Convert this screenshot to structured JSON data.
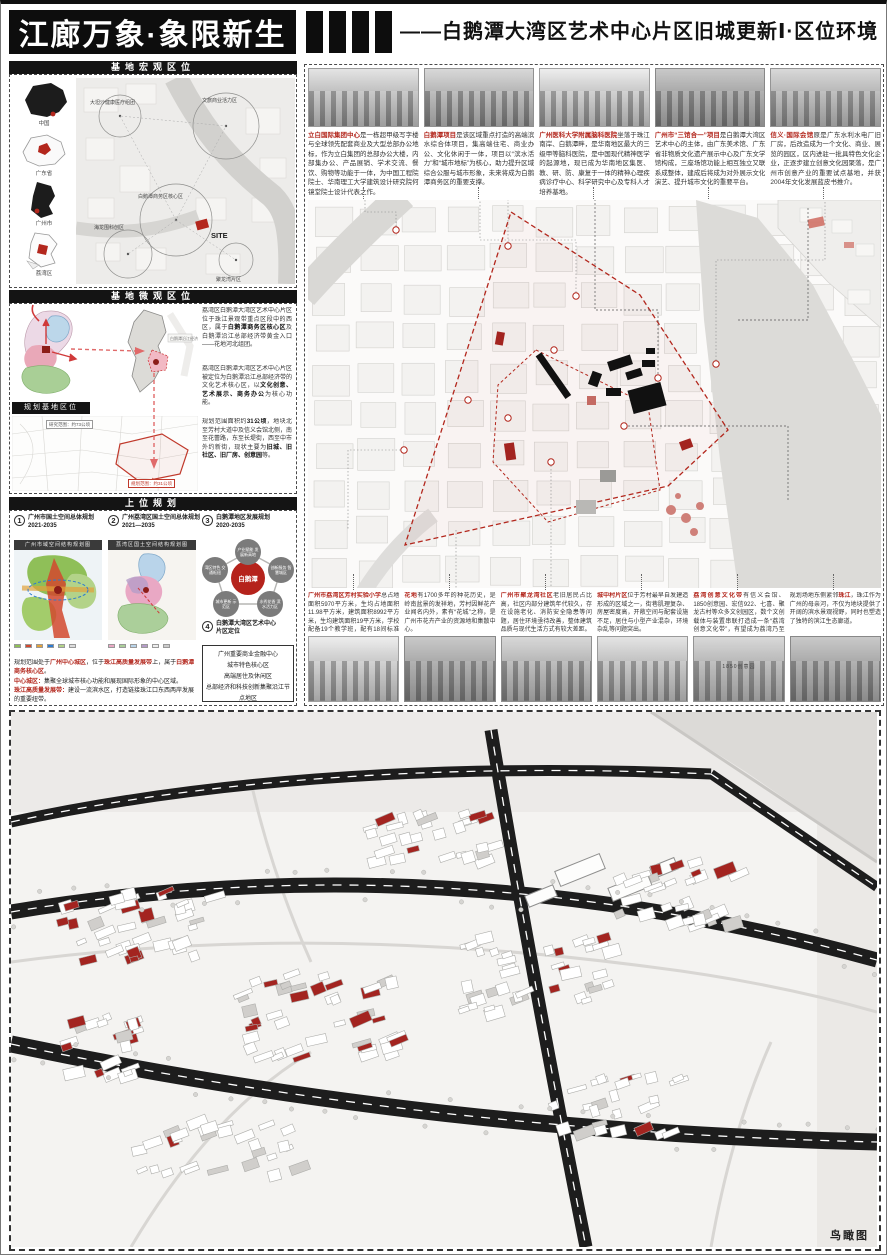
{
  "page": {
    "aerial_label": "鸟瞰图"
  },
  "colors": {
    "accent": "#b3271d",
    "black": "#141414"
  },
  "header": {
    "logo": "江廊万象·象限新生",
    "title": "——白鹅潭大湾区艺术中心片区旧城更新Ⅰ·区位环境"
  },
  "left": {
    "macro_title": "基地宏观区位",
    "inset_captions": [
      "中国",
      "广东省",
      "广州市",
      "荔湾区"
    ],
    "macro_labels": [
      "大坦沙健康医疗组团",
      "文旅商业活力区",
      "白鹅潭商务区核心区",
      "SITE",
      "聚龙湾片区",
      "海龙围科创区"
    ],
    "micro_title": "基地微观区位",
    "micro_para1": [
      {
        "t": "荔湾区白鹅潭大湾区艺术中心片区位于珠江景观带重点区段中的西区，属于"
      },
      {
        "t": "白鹅潭商务区核心区",
        "s": "b"
      },
      {
        "t": "及白鹅潭沿江总部经济带黄金入口——花地河北组团。"
      }
    ],
    "micro_para2": [
      {
        "t": "荔湾区白鹅潭大湾区艺术中心片区被定位为白鹅潭沿江总部经济带的文化艺术核心区，以"
      },
      {
        "t": "文化创意、艺术展示、商务办公",
        "s": "b"
      },
      {
        "t": "为核心功能。"
      }
    ],
    "base_tag": "规划基地区位",
    "base_note_top": "研究范围：约73公顷",
    "base_note": "规划范围：约31公顷",
    "base_para": [
      {
        "t": "规划范围面积约"
      },
      {
        "t": "31公顷",
        "s": "b"
      },
      {
        "t": "，地块北至芳村大道中及信义会馆北侧，南至花蕾路，东至长堤街，西至中市外约新街，现状主要为"
      },
      {
        "t": "旧城、旧社区、旧厂房、创意园",
        "s": "b"
      },
      {
        "t": "等。"
      }
    ],
    "upper_title": "上位规划",
    "items": [
      {
        "num": "1",
        "l1": "广州市国土空间总体规划",
        "l2": "2021-2035"
      },
      {
        "num": "2",
        "l1": "广州荔湾区国土空间总体规划",
        "l2": "2021—2035"
      },
      {
        "num": "3",
        "l1": "白鹅潭地区发展规划",
        "l2": "2020-2035"
      },
      {
        "num": "4",
        "l1": "白鹅潭大湾区艺术中心",
        "l2": "片区定位"
      }
    ],
    "map1_title": "广州市域空间结构规划图",
    "map2_title": "荔湾区国土空间结构规划图",
    "diagram": {
      "center": "白鹅潭",
      "nodes": [
        "产业赋能 发展新高地",
        "创新服务 智慧城区",
        "水秀花香 滨水活力区",
        "城市更新 示范区",
        "湾区特色 交通枢纽"
      ]
    },
    "position_box": [
      "广州重要商业金融中心",
      "城市特色核心区",
      "高端居住及休闲区",
      "总部经济和科技创新集聚沿江节点地区"
    ],
    "footer": [
      [
        {
          "t": "规划范围处于"
        },
        {
          "t": "广州中心城区",
          "s": "hl"
        },
        {
          "t": "，位于"
        },
        {
          "t": "珠江高质量发展带",
          "s": "hl"
        },
        {
          "t": "上，属于"
        },
        {
          "t": "白鹅潭商务核心区",
          "s": "hl"
        },
        {
          "t": "。"
        }
      ],
      [
        {
          "t": "中心城区：",
          "s": "hl"
        },
        {
          "t": "集聚全球城市核心功能和展现国际形象的中心区域。"
        }
      ],
      [
        {
          "t": "珠江高质量发展带：",
          "s": "hl"
        },
        {
          "t": "建设一流滨水区，打造链接珠江口东西两岸发展的重要纽带。"
        }
      ],
      [
        {
          "t": "白鹅潭商务核心区：",
          "s": "hl"
        },
        {
          "t": "积极赋能，打造链接珠江西岸的商务核心区。"
        }
      ]
    ]
  },
  "top_captions": [
    {
      "text": [
        {
          "t": "立白国际集团中心",
          "s": "hl"
        },
        {
          "t": "是一栋超甲级写字楼与全球领先配套商业及大型总部办公地标，作为立白集团的总部办公大楼，内部集办公、产品展销、学术交流、餐饮、购物等功能于一体，为中国工程院院士、华南理工大学建筑设计研究院何镜堂院士设计代表之作。"
        }
      ]
    },
    {
      "text": [
        {
          "t": "白鹅潭项目",
          "s": "hl"
        },
        {
          "t": "是该区域重点打造的高端滨水综合体项目，集高端住宅、商业办公、文化休闲于一体，项目以“滨水活力”和“城市地标”为核心，助力提升区域综合公服与城市形象，未来将成为白鹅潭商务区的重要支撑。"
        }
      ]
    },
    {
      "text": [
        {
          "t": "广州医科大学附属脑科医院",
          "s": "hl"
        },
        {
          "t": "坐落于珠江南岸、白鹅潭畔，是华南地区最大的三级甲等脑科医院，是中国现代精神医学的起源地，现已成为华南地区集医、教、研、防、康复于一体的精神心理疾病诊疗中心、科学研究中心及专科人才培养基地。"
        }
      ]
    },
    {
      "text": [
        {
          "t": "广州市“三馆合一”项目",
          "s": "hl"
        },
        {
          "t": "是白鹅潭大湾区艺术中心的主体，由广东美术馆、广东省非物质文化遗产展示中心及广东文学馆构成，三座场馆功能上相互独立又联系成整体，建成后将成为对外展示文化演艺、提升城市文化的重要平台。"
        }
      ]
    },
    {
      "text": [
        {
          "t": "信义·国际会馆",
          "s": "hl"
        },
        {
          "t": "原是广东水利水电厂旧厂房，后改造成为一个文化、商业、展览的园区，区内进驻一批具特色文化企业，正逐步建立创意文化园聚落，是广州市创意产业的重要试点基地，并获2004年文化发展蓝皮书推介。"
        }
      ]
    }
  ],
  "bottom_captions": [
    {
      "text": [
        {
          "t": "广州市荔湾区芳村实验小学",
          "s": "hl"
        },
        {
          "t": "总占地面积5970平方米，生均占地面积11.98平方米，建筑面积8992平方米，生均建筑面积19平方米，学校配备19个教学班，配有18间标准课室。"
        }
      ]
    },
    {
      "text": [
        {
          "t": "花地",
          "s": "hl"
        },
        {
          "t": "有1700多年的种花历史，是岭南盆景的发祥地，芳村因鲜花产业闻名内外，素有“花城”之称，是广州市花卉产业的资源地和集散中心。"
        }
      ]
    },
    {
      "text": [
        {
          "t": "广州市聚龙湾社区",
          "s": "hl"
        },
        {
          "t": "老旧居民占比高，社区内部分建筑年代较久，存在设施老化、消防安全隐患等问题，居住环境亟待改善，整体建筑品质与现代生活方式有较大差距。"
        }
      ]
    },
    {
      "text": [
        {
          "t": "城中村片区",
          "s": "hl"
        },
        {
          "t": "位于芳村最早自发建造形成的区域之一，街巷肌理复杂、房屋密度高，开敞空间与配套设施不足，居住与小型产业混杂，环境杂乱等问题突出。"
        }
      ]
    },
    {
      "text": [
        {
          "t": "荔湾创意文化带",
          "s": "hl"
        },
        {
          "t": "有信义会馆、1850创意园、宏信922、七喜、聚龙古村等众多文创园区，数个文创载体与装置串联打造成一条“荔湾创意文化带”，有望成为荔湾乃至广州的一张名片。"
        }
      ]
    },
    {
      "text": [
        {
          "t": "规划场地东侧紧邻"
        },
        {
          "t": "珠江",
          "s": "hl"
        },
        {
          "t": "，珠江作为广州的母亲河，不仅为地块提供了开阔的滨水景观视野，同时也塑造了独特的滨江生态廊道。"
        }
      ]
    }
  ],
  "bottom_sign": "1850创意园"
}
